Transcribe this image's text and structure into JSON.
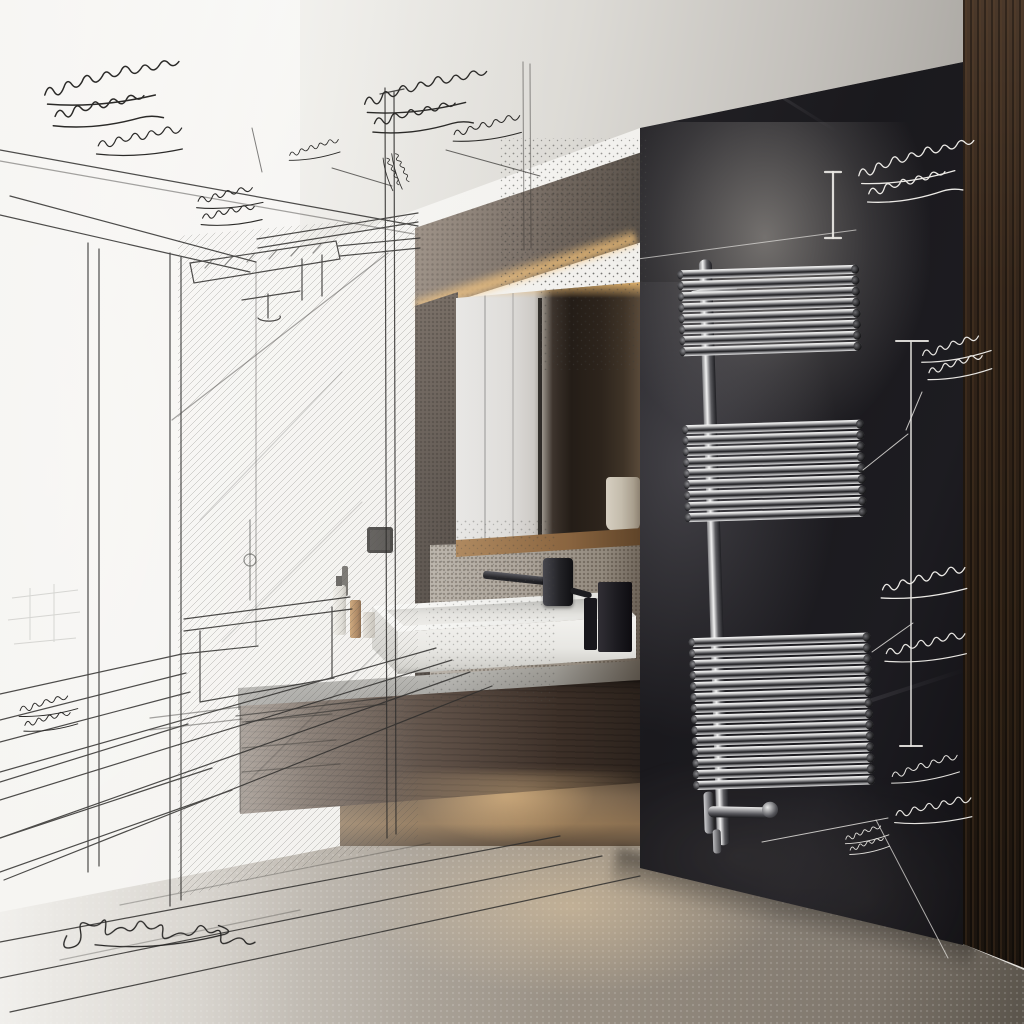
{
  "scene": {
    "title": "Bathroom concept visualization — left half architect pencil sketch, right half photorealistic render with chrome towel radiator on black marble panel",
    "style": "sketch-to-photo interior rendering",
    "colors": {
      "paper": "#f4f3f0",
      "ceiling": "#d8d6d2",
      "stone_beam": "#7c7168",
      "panel_black": "#1a191d",
      "wood_paneling": "#33251a",
      "cabinet_walnut": "#4c3c32",
      "counter_grey": "#bcbbb6",
      "sink_white": "#f3f2ef",
      "chrome": "#d4d4d4",
      "floor_concrete": "#a49c91",
      "warm_glow": "#f0be73",
      "pencil": "#2f2e2c",
      "chalk": "#eceae6"
    },
    "regions": {
      "left": "pencil sketch: window, glass shower enclosure, bench, floor perspective lines",
      "center": "photoreal: backlit mirror, stone beam with cove light, floating walnut vanity, white vessel sink, black wall faucet",
      "right": "black marble panel with chrome towel radiator, chalk annotations, dark wood paneling column"
    }
  },
  "radiator": {
    "description": "chrome horizontal-tube towel radiator in three banks",
    "pitch": 11,
    "banks": [
      {
        "y": 14,
        "count": 8
      },
      {
        "y": 169,
        "count": 9
      },
      {
        "y": 382,
        "count": 14
      }
    ]
  },
  "annotations": [
    {
      "id": "note-top-left-1",
      "layer": "pencil",
      "variant": "A",
      "x": 42,
      "y": 86,
      "s": 1.15,
      "r": -3,
      "w": 1.3,
      "color": "#2b2a28",
      "text": "illegible handwritten note"
    },
    {
      "id": "note-top-left-2",
      "layer": "pencil",
      "variant": "B",
      "x": 96,
      "y": 140,
      "s": 1.0,
      "r": -2,
      "w": 1.2,
      "color": "#2b2a28",
      "text": "illegible handwritten note"
    },
    {
      "id": "note-top-left-3",
      "layer": "pencil",
      "variant": "C",
      "x": 196,
      "y": 196,
      "s": 0.9,
      "r": -3,
      "w": 1.2,
      "color": "#2b2a28",
      "text": "illegible handwritten note"
    },
    {
      "id": "note-top-left-4",
      "layer": "pencil",
      "variant": "B",
      "x": 288,
      "y": 152,
      "s": 0.6,
      "r": -8,
      "w": 1.4,
      "color": "#2b2a28",
      "text": "illegible handwritten note"
    },
    {
      "id": "note-top-mid-1",
      "layer": "pencil",
      "variant": "A",
      "x": 362,
      "y": 96,
      "s": 1.05,
      "r": -4,
      "w": 1.3,
      "color": "#2b2a28",
      "text": "illegible handwritten note"
    },
    {
      "id": "note-top-mid-2",
      "layer": "pencil",
      "variant": "B",
      "x": 452,
      "y": 130,
      "s": 0.8,
      "r": -6,
      "w": 1.3,
      "color": "#2b2a28",
      "text": "illegible handwritten note"
    },
    {
      "id": "note-glyph",
      "layer": "pencil",
      "variant": "C",
      "x": 398,
      "y": 152,
      "s": 0.5,
      "r": 75,
      "w": 1.6,
      "color": "#2b2a28",
      "text": "small detail sketch"
    },
    {
      "id": "note-left-margin",
      "layer": "pencil",
      "variant": "C",
      "x": 18,
      "y": 706,
      "s": 0.8,
      "r": -6,
      "w": 1.2,
      "color": "#2b2a28",
      "text": "illegible handwritten note"
    },
    {
      "id": "signature",
      "layer": "pencil",
      "variant": "D",
      "x": 60,
      "y": 916,
      "s": 1.0,
      "r": -2,
      "w": 1.3,
      "color": "#242322",
      "text": "designer signature (illegible)"
    },
    {
      "id": "chalk-top",
      "layer": "chalk",
      "variant": "A",
      "x": 856,
      "y": 168,
      "s": 1.0,
      "r": -6,
      "w": 1.3,
      "color": "#eceae6",
      "text": "illegible chalk note"
    },
    {
      "id": "chalk-upper",
      "layer": "chalk",
      "variant": "C",
      "x": 920,
      "y": 350,
      "s": 0.95,
      "r": -8,
      "w": 1.3,
      "color": "#e7e5e1",
      "text": "illegible chalk note"
    },
    {
      "id": "chalk-mid-1",
      "layer": "chalk",
      "variant": "B",
      "x": 880,
      "y": 584,
      "s": 1.0,
      "r": -5,
      "w": 1.3,
      "color": "#eceae6",
      "text": "illegible chalk note"
    },
    {
      "id": "chalk-mid-2",
      "layer": "chalk",
      "variant": "B",
      "x": 884,
      "y": 648,
      "s": 0.95,
      "r": -4,
      "w": 1.3,
      "color": "#e7e5e1",
      "text": "illegible chalk note"
    },
    {
      "id": "chalk-low-1",
      "layer": "chalk",
      "variant": "B",
      "x": 890,
      "y": 772,
      "s": 0.8,
      "r": -8,
      "w": 1.3,
      "color": "#e2e0dc",
      "text": "illegible chalk note"
    },
    {
      "id": "chalk-low-2",
      "layer": "chalk",
      "variant": "B",
      "x": 894,
      "y": 810,
      "s": 0.9,
      "r": -3,
      "w": 1.3,
      "color": "#e7e5e1",
      "text": "illegible chalk note"
    },
    {
      "id": "chalk-low-3",
      "layer": "chalk",
      "variant": "C",
      "x": 844,
      "y": 836,
      "s": 0.6,
      "r": -10,
      "w": 1.5,
      "color": "#dddbd7",
      "text": "illegible chalk note"
    }
  ],
  "chalk_lines": [
    {
      "id": "dim1-bar",
      "x1": 833,
      "y1": 172,
      "x2": 833,
      "y2": 238,
      "w": 2.2,
      "op": 0.92
    },
    {
      "id": "dim1-cap1",
      "x1": 825,
      "y1": 172,
      "x2": 841,
      "y2": 172,
      "w": 2.2,
      "op": 0.92
    },
    {
      "id": "dim1-cap2",
      "x1": 825,
      "y1": 238,
      "x2": 841,
      "y2": 238,
      "w": 2.2,
      "op": 0.92
    },
    {
      "id": "dim2-bar",
      "x1": 911,
      "y1": 342,
      "x2": 911,
      "y2": 746,
      "w": 1.6,
      "op": 0.88
    },
    {
      "id": "dim2-cap1",
      "x1": 896,
      "y1": 341,
      "x2": 928,
      "y2": 341,
      "w": 2.0,
      "op": 0.9
    },
    {
      "id": "dim2-cap2",
      "x1": 900,
      "y1": 746,
      "x2": 922,
      "y2": 746,
      "w": 2.0,
      "op": 0.9
    },
    {
      "id": "leader-1",
      "x1": 863,
      "y1": 470,
      "x2": 908,
      "y2": 434,
      "w": 1.0,
      "op": 0.8
    },
    {
      "id": "leader-2",
      "x1": 872,
      "y1": 652,
      "x2": 913,
      "y2": 623,
      "w": 1.0,
      "op": 0.8
    },
    {
      "id": "leader-3",
      "x1": 762,
      "y1": 842,
      "x2": 888,
      "y2": 818,
      "w": 1.0,
      "op": 0.8
    },
    {
      "id": "leader-4",
      "x1": 876,
      "y1": 820,
      "x2": 948,
      "y2": 958,
      "w": 1.0,
      "op": 0.7
    },
    {
      "id": "leader-5",
      "x1": 615,
      "y1": 262,
      "x2": 856,
      "y2": 230,
      "w": 0.9,
      "op": 0.65
    },
    {
      "id": "leader-6",
      "x1": 906,
      "y1": 430,
      "x2": 922,
      "y2": 392,
      "w": 1.0,
      "op": 0.8
    }
  ],
  "pencil_lines": [
    {
      "id": "lead-a",
      "x1": 332,
      "y1": 168,
      "x2": 392,
      "y2": 186,
      "w": 1.0,
      "op": 0.7
    },
    {
      "id": "lead-b",
      "x1": 446,
      "y1": 150,
      "x2": 540,
      "y2": 176,
      "w": 1.0,
      "op": 0.7
    },
    {
      "id": "lead-c",
      "x1": 252,
      "y1": 128,
      "x2": 262,
      "y2": 172,
      "w": 1.0,
      "op": 0.6
    }
  ]
}
